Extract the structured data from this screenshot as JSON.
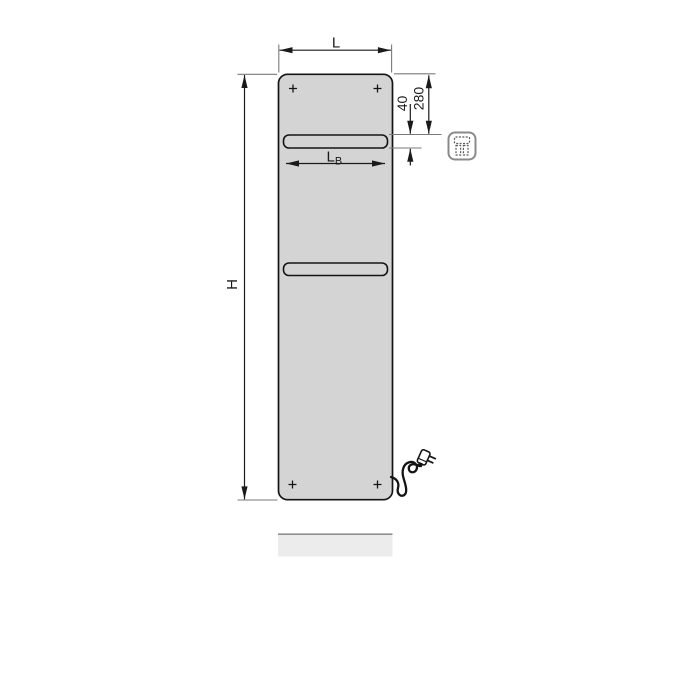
{
  "colors": {
    "background": "#ffffff",
    "panel": "#d4d4d4",
    "outline": "#141414",
    "dim": "#1a1a1a",
    "ext": "#7a7a7a",
    "icon_border": "#8a8a8a",
    "icon_inner": "#5a5a5a",
    "strip": "#ececec",
    "strip_edge": "#8f8f8f"
  },
  "labels": {
    "width": "L",
    "height": "H",
    "bar_width_main": "L",
    "bar_width_sub": "B",
    "top_distance": "280",
    "bar_opening": "40"
  },
  "icons": {
    "electric": "electric-plug-icon"
  }
}
